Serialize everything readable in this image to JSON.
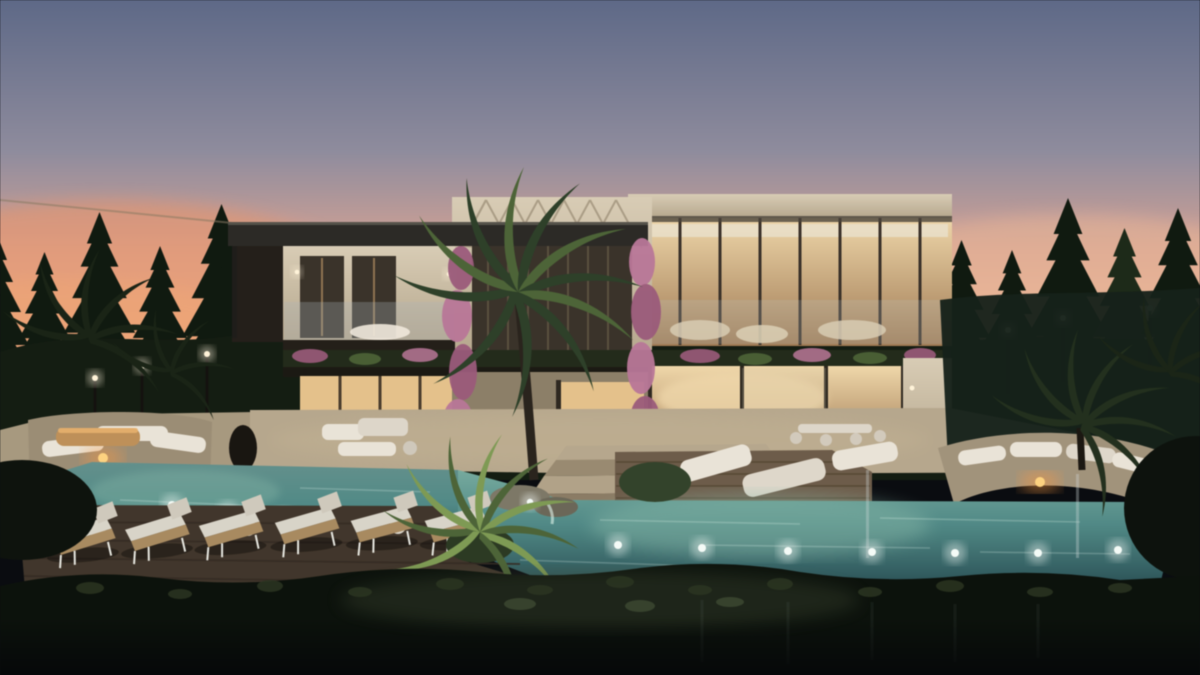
{
  "scene": {
    "type": "3d-architectural-rendering",
    "description": "Twilight rendering of a modern two-storey luxury stone villa: warm lit glass interiors, dark flat roofs, glass balconies with bougainvillea planters, tall pine trees and garden lamps behind, palm trees, an infinity-edge pool with underwater lights, rattan sun loungers on a wooden deck, sunken lounges with fire pits, and a dark hedge foreground under a pink-orange sunset sky.",
    "time_of_day": "dusk",
    "setting": "luxury villa with pool and landscaped garden",
    "features": [
      "infinity pool with underwater lights",
      "rattan sun loungers",
      "central palm tree",
      "pine tree backdrop",
      "bougainvillea climbers",
      "fire pit lounges",
      "glass balconies",
      "warm interior lighting",
      "wooden pool deck",
      "foreground hedge"
    ],
    "counts": {
      "storeys": 2,
      "sun_loungers": 6,
      "side_tables": 3,
      "pool_lights_left": 4,
      "pool_lights_right": 8,
      "garden_lamps": 7,
      "fire_pits": 2
    }
  },
  "palette": {
    "sky_top": "#5e6988",
    "sky_mid": "#8f8c9e",
    "sky_pink": "#d6a394",
    "sky_peach": "#efb894",
    "sunset_orange": "#ee9466",
    "tree_dark": "#101a10",
    "tree_soft": "#1d2a18",
    "bush_dark": "#141d12",
    "stone_light": "#d8ccb4",
    "stone_mid": "#b7a78c",
    "stone_shadow": "#8d7f67",
    "roof_dark": "#2c2a26",
    "roof_edge": "#55524a",
    "louver_dark": "#3a332a",
    "window_warm": "#e5c189",
    "interior_bright": "#f0d7a8",
    "interior_deep": "#a07a52",
    "flower_purple": "#9d5a7c",
    "flower_light": "#bb7699",
    "palm_dark": "#2d4028",
    "palm_mid": "#4c6436",
    "palm_bright": "#7d9a52",
    "pool_aqua": "#8fc0ae",
    "pool_mid": "#4f8a86",
    "pool_deep": "#284e54",
    "edge_dark": "#17211d",
    "deck_wood": "#6e5c49",
    "deck_dark": "#41362b",
    "cushion_white": "#e9e3d6",
    "rattan": "#a98a5e",
    "fire_orange": "#ff9a3c",
    "fire_core": "#ffd27c",
    "lamp_glow": "#fff3d8",
    "hedge_dark": "#0c120c",
    "hedge_leaf": "#2b3520",
    "hedge_lit": "#49533a",
    "night_black": "#060809",
    "light_white": "#f4fbf7"
  }
}
